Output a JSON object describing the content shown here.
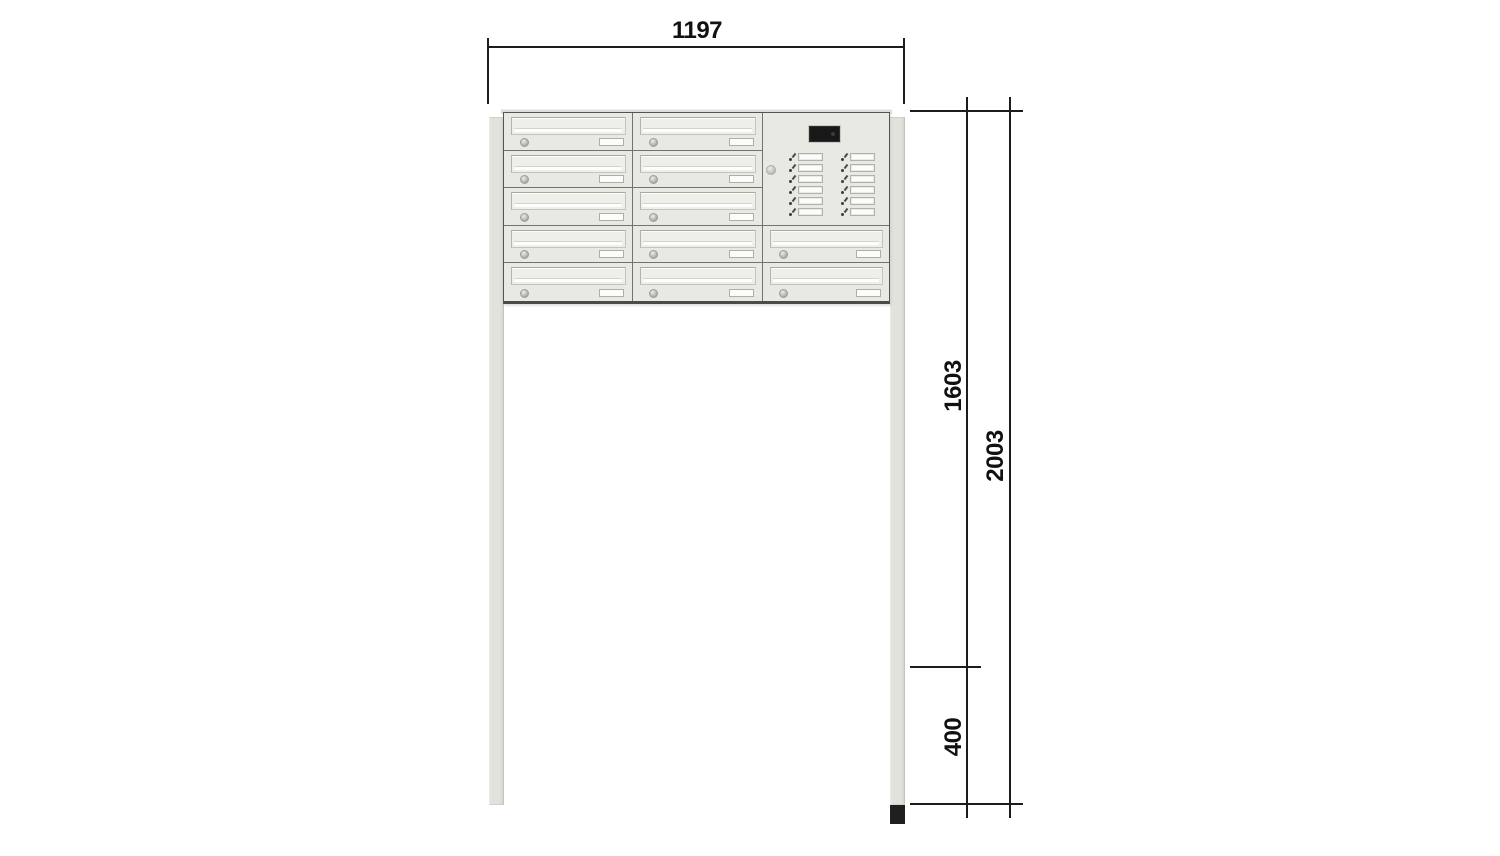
{
  "page": {
    "background": "#ffffff"
  },
  "drawing": {
    "title": "Free-standing mailbox bank with intercom panel, dimensioned front view",
    "dimensions": {
      "overall_width_mm": "1197",
      "height_above_ground_mm": "1603",
      "total_height_mm": "2003",
      "anchor_depth_mm": "400"
    },
    "unit": {
      "total_mailboxes": 12,
      "mailbox_columns": [
        {
          "id": "column-1",
          "grid_col": 1,
          "rows": [
            1,
            2,
            3,
            4,
            5
          ]
        },
        {
          "id": "column-2",
          "grid_col": 2,
          "rows": [
            1,
            2,
            3,
            4,
            5
          ]
        },
        {
          "id": "column-3",
          "grid_col": 3,
          "rows": [
            4,
            5
          ]
        }
      ],
      "intercom": {
        "grid_col": 3,
        "row_span": [
          1,
          3
        ],
        "bell_columns": 2,
        "bells_per_column": 6,
        "total_bell_buttons": 12,
        "has_display": true,
        "has_lock": true
      }
    },
    "colors": {
      "page_bg": "#ffffff",
      "line": "#1c1c1c",
      "label": "#111111",
      "unit_body": "#e9e9e3",
      "unit_border": "#55554f",
      "cell_divider": "#73736d",
      "flap": "#efefe9",
      "slot": "#fdfdfc",
      "plate": "#fcfcfa",
      "post": "#e2e2dc",
      "anchor_foot": "#1f1f1f",
      "display": "#181818"
    }
  }
}
